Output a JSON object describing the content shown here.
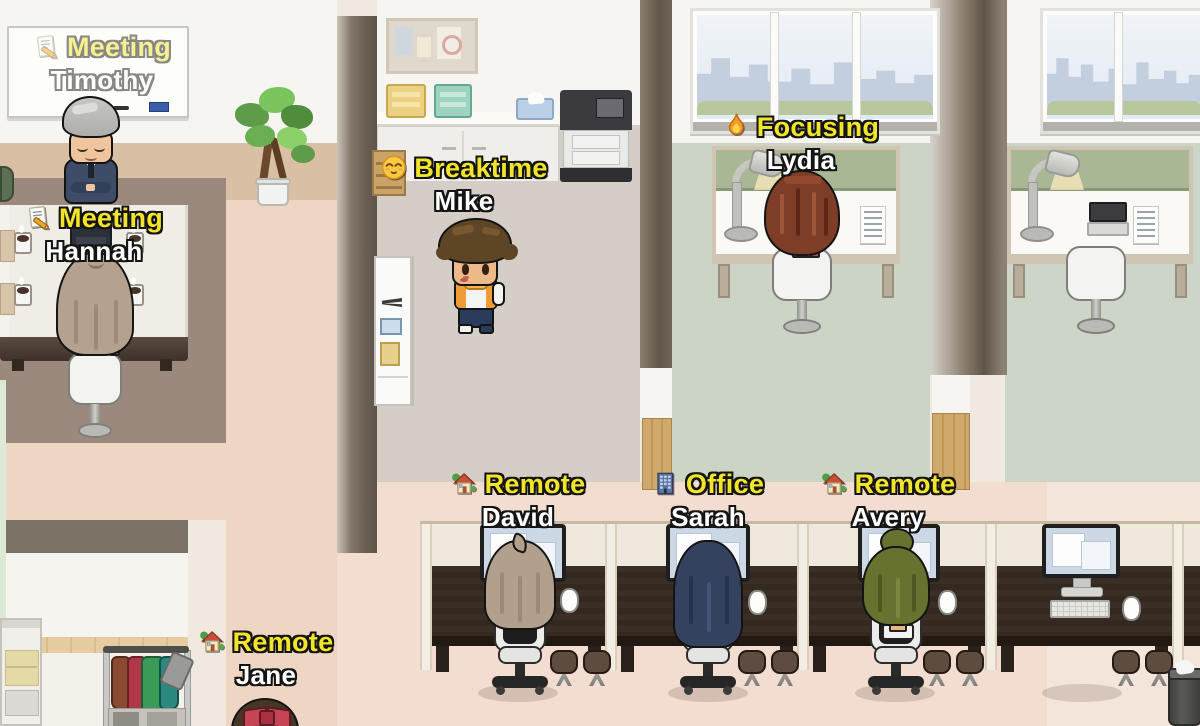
{
  "ui_colors": {
    "status_text": "#f2e529",
    "name_text": "#ffffff",
    "label_outline": "#141414"
  },
  "characters": [
    {
      "id": "timothy",
      "name": "Timothy",
      "status": "Meeting",
      "emoji": "memo",
      "icon_ref": "#icon-memo",
      "faded": true
    },
    {
      "id": "hannah",
      "name": "Hannah",
      "status": "Meeting",
      "emoji": "memo",
      "icon_ref": "#icon-memo"
    },
    {
      "id": "mike",
      "name": "Mike",
      "status": "Breaktime",
      "emoji": "relieved-face",
      "icon_ref": "#icon-relieved"
    },
    {
      "id": "lydia",
      "name": "Lydia",
      "status": "Focusing",
      "emoji": "fire",
      "icon_ref": "#icon-fire"
    },
    {
      "id": "david",
      "name": "David",
      "status": "Remote",
      "emoji": "house-with-garden",
      "icon_ref": "#icon-house"
    },
    {
      "id": "sarah",
      "name": "Sarah",
      "status": "Office",
      "emoji": "office-building",
      "icon_ref": "#icon-office"
    },
    {
      "id": "avery",
      "name": "Avery",
      "status": "Remote",
      "emoji": "house-with-garden",
      "icon_ref": "#icon-house"
    },
    {
      "id": "jane",
      "name": "Jane",
      "status": "Remote",
      "emoji": "house-with-garden",
      "icon_ref": "#icon-house"
    }
  ]
}
